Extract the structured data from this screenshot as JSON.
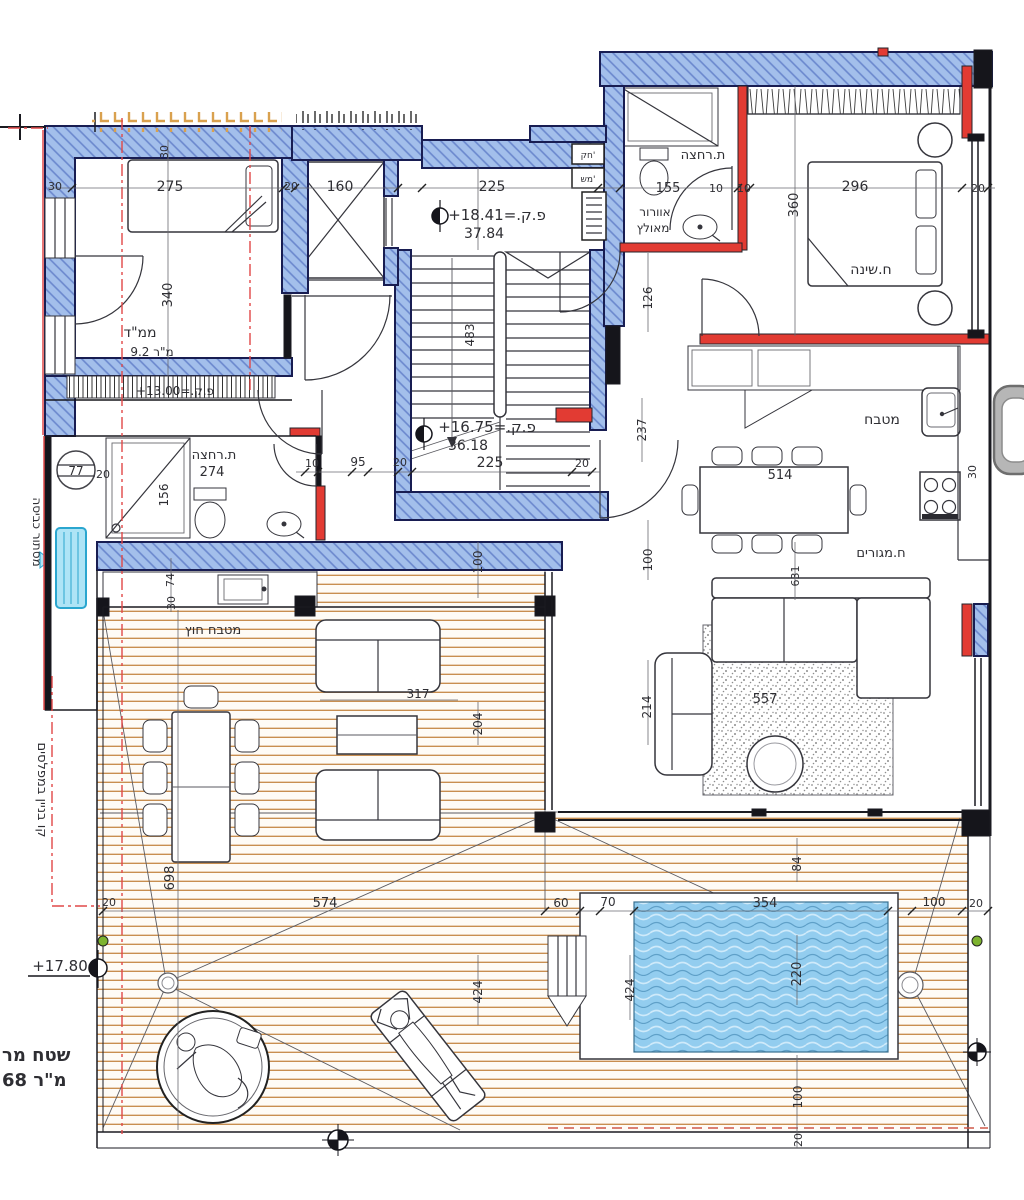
{
  "drawing_type": "architectural floor plan (penthouse level with roof deck and pool)",
  "colors": {
    "wall_blue_fill": "#a3bfeb",
    "wall_blue_hatch": "#6a87cd",
    "wall_outline": "#181d52",
    "wall_red": "#e23b33",
    "deck_wood_line": "#c88e50",
    "pool_water": "#93cdef",
    "pool_wave_dark": "#5fa0c8",
    "rug_speckle": "#8e8e8e",
    "ac_unit": "#aee4f6",
    "marker_green": "#7db32f",
    "red_guideline": "#e04848",
    "tan_ticks": "#d9a14e",
    "grey_object": "#b6b6b6"
  },
  "rooms": {
    "mamad": "ממ\"ד",
    "mamad_area": "9.2 מ\"ר",
    "bath_top": "ת.רחצה",
    "vent1": "אוורור",
    "vent2": "מאולץ",
    "bedroom": "ח.שינה",
    "kitchen": "מטבח",
    "living": "ח.מגורים",
    "bath_mid": "ת.רחצה",
    "bath_mid_w": "274",
    "outdoor_kitchen": "מטבח חוץ",
    "laundry": "מסתור כביסה"
  },
  "levels": {
    "upper_rel": "+18.41=.ק.פ",
    "upper_abs": "37.84",
    "mid_rel": "+16.75=.ק.פ",
    "mid_abs": "36.18",
    "mamad_rel": "+13.00=.ק.פ",
    "deck_rel": "+17.80"
  },
  "notes": {
    "building_line": "קו בניין במפלסים",
    "area1": "שטח מר",
    "area2": "68 מ\"ר",
    "shaft1": "חק'",
    "shaft2": "מש'",
    "bubble77": "77"
  },
  "dims": {
    "top30_rot": "30",
    "left30": "30",
    "mamad_w": "275",
    "mamad_right20": "20",
    "mamad_h": "340",
    "elev_w": "160",
    "stair_w": "225",
    "stair_h": "483",
    "bath1_w": "155",
    "bath1_10": "10",
    "bed_w": "296",
    "bedroom_10": "10",
    "bedroom_20": "20",
    "bedroom_h": "360",
    "vent_h": "126",
    "hall_10": "10",
    "hall_95": "95",
    "hall_20": "20",
    "landing_w": "225",
    "landing_20r": "20",
    "landing_h237": "237",
    "shower_d": "156",
    "counter74": "74",
    "counter30": "30",
    "deck100a": "100",
    "mid100": "100",
    "table_w": "514",
    "kitchen30": "30",
    "sofa631": "631",
    "rug557": "557",
    "liv214": "214",
    "deck317": "317",
    "deck204": "204",
    "deck698": "698",
    "deck574": "574",
    "deck20": "20",
    "pool60": "60",
    "pool70": "70",
    "pool354": "354",
    "pool100r": "100",
    "pool20r": "20",
    "deck424": "424",
    "pool424": "424",
    "pool220": "220",
    "pool84": "84",
    "pool100b": "100",
    "pool20b": "20",
    "laundry20": "20"
  }
}
